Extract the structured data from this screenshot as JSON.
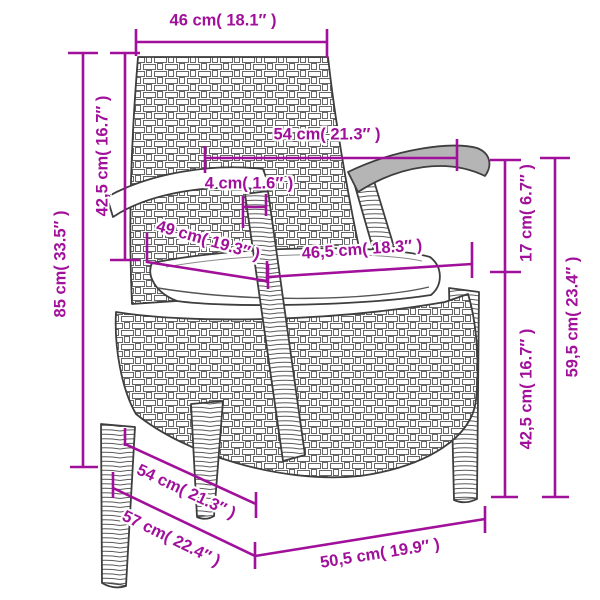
{
  "diagram": {
    "product": "rattan-garden-chair-with-cushion",
    "colors": {
      "accent": "#A1109B",
      "outline": "#3e3e3e",
      "weave_stroke": "#666666",
      "armrest_gray": "#b5b5b5",
      "cushion_shadow": "#9c9c9c",
      "background": "#ffffff"
    },
    "dims": {
      "top_width": {
        "label": "46 cm( 18.1″ )",
        "cm": "46",
        "in": "18.1"
      },
      "back_height": {
        "label": "42,5 cm( 16.7″ )",
        "cm": "42,5",
        "in": "16.7"
      },
      "total_height": {
        "label": "85 cm( 33.5″ )",
        "cm": "85",
        "in": "33.5"
      },
      "armrest_span": {
        "label": "54 cm( 21.3″ )",
        "cm": "54",
        "in": "21.3"
      },
      "armrest_post": {
        "label": "4 cm( 1.6″ )",
        "cm": "4",
        "in": "1.6"
      },
      "seat_depth": {
        "label": "49 cm( 19.3″ )",
        "cm": "49",
        "in": "19.3"
      },
      "seat_width": {
        "label": "46,5 cm( 18.3″ )",
        "cm": "46,5",
        "in": "18.3"
      },
      "arm_above_seat": {
        "label": "17 cm( 6.7″ )",
        "cm": "17",
        "in": "6.7"
      },
      "seat_height": {
        "label": "42,5 cm( 16.7″ )",
        "cm": "42,5",
        "in": "16.7"
      },
      "armrest_height": {
        "label": "59,5 cm( 23.4″ )",
        "cm": "59,5",
        "in": "23.4"
      },
      "depth_upper": {
        "label": "54 cm( 21.3″ )",
        "cm": "54",
        "in": "21.3"
      },
      "depth_lower": {
        "label": "57 cm( 22.4″ )",
        "cm": "57",
        "in": "22.4"
      },
      "front_width": {
        "label": "50,5 cm( 19.9″ )",
        "cm": "50,5",
        "in": "19.9"
      }
    }
  }
}
